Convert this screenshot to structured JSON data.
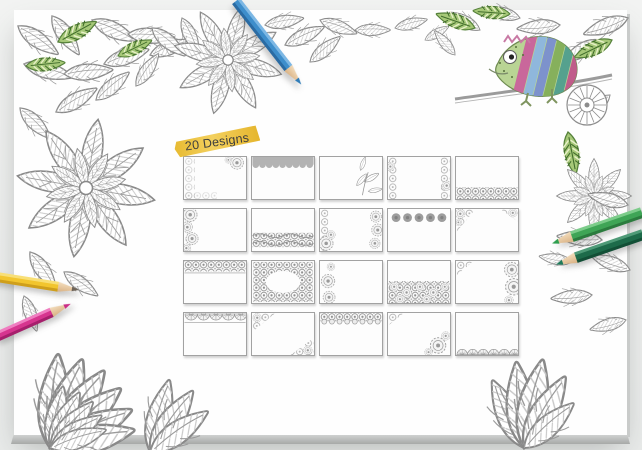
{
  "page": {
    "background": "#edefee"
  },
  "board": {
    "background": "#ffffff",
    "bevel_color": "#b2b4b3"
  },
  "badge": {
    "label": "20 Designs",
    "highlight_color": "#eec243",
    "text_color": "#3e3e3e"
  },
  "designs": [
    {
      "name": "Floral lace left edge with corner bloom"
    },
    {
      "name": "Solid scalloped banner along top"
    },
    {
      "name": "Leaf spray on right side"
    },
    {
      "name": "Lace borders on left and right edges"
    },
    {
      "name": "Floral meadow band along bottom"
    },
    {
      "name": "Rose cluster down left edge"
    },
    {
      "name": "Ornate wave band across bottom"
    },
    {
      "name": "Lace left edge with blooms on right"
    },
    {
      "name": "Row of dotted circles along top"
    },
    {
      "name": "Paisley ornaments in top corners"
    },
    {
      "name": "Lace band across top"
    },
    {
      "name": "Full floral wreath frame with open center"
    },
    {
      "name": "Citrus slice medallions on left edge"
    },
    {
      "name": "Flower field covering bottom half"
    },
    {
      "name": "Corner lace with mandalas on right edge"
    },
    {
      "name": "Garland scallop band along top"
    },
    {
      "name": "Lace corners top-left and bottom-right"
    },
    {
      "name": "Ornate border with scallops along top"
    },
    {
      "name": "Corner lace with bottom-right mandala"
    },
    {
      "name": "Row of scalloped fans along bottom"
    }
  ],
  "pencils": [
    {
      "name": "blue-pencil",
      "color": "#3e8ecb"
    },
    {
      "name": "yellow-pencil",
      "color": "#f2c52e"
    },
    {
      "name": "magenta-pencil",
      "color": "#d6358f"
    },
    {
      "name": "light-green-pencil",
      "color": "#3fa556"
    },
    {
      "name": "dark-green-pencil",
      "color": "#1d6b4a"
    }
  ],
  "illustrations": [
    {
      "name": "chameleon-illustration",
      "description": "partly colored zentangle chameleon on a branch with coiled tail",
      "colors": [
        "#c9679b",
        "#8fb7dc",
        "#7d92cc",
        "#86b05c",
        "#55a18e"
      ]
    },
    {
      "name": "flower-line-art",
      "description": "gray hatched flowers and leaves to color in"
    },
    {
      "name": "green-leaves",
      "description": "leaves already colored green",
      "color": "#a6c878"
    }
  ]
}
